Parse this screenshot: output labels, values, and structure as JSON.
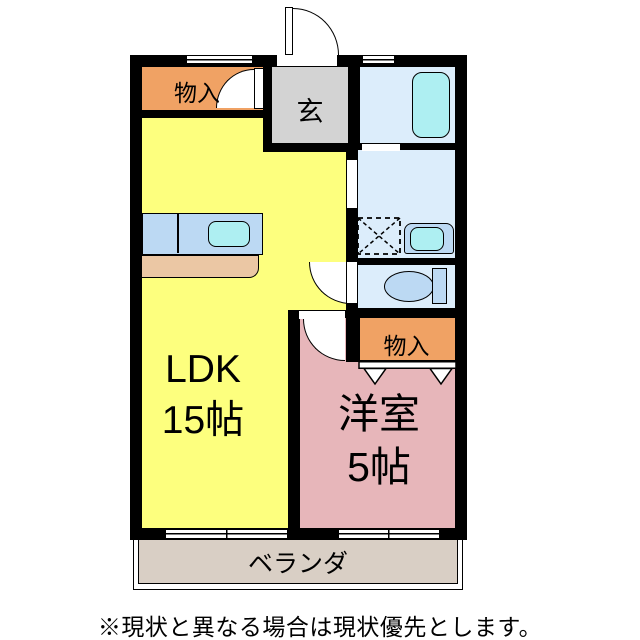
{
  "floor_plan": {
    "rooms": {
      "ldk": {
        "label": "LDK",
        "area": "15帖",
        "color": "#FDFF7E"
      },
      "western_room": {
        "label": "洋室",
        "area": "5帖",
        "color": "#E7B6BA"
      },
      "entrance": {
        "label": "玄",
        "color": "#D3D3D3"
      },
      "storage_top": {
        "label": "物入",
        "color": "#F0A264"
      },
      "storage_bedroom": {
        "label": "物入",
        "color": "#F0A264"
      },
      "bathroom": {
        "color": "#DCEDFB"
      },
      "washroom": {
        "color": "#DCEDFB"
      },
      "toilet_room": {
        "color": "#DCEDFB"
      },
      "veranda": {
        "label": "ベランダ",
        "color": "#D9CFC5"
      }
    },
    "fixtures": {
      "bathtub": "bathtub",
      "kitchen_counter": "kitchen-counter",
      "kitchen_sink": "kitchen-sink",
      "washing_machine_space": "washing-machine-space",
      "wash_basin": "wash-basin",
      "toilet": "toilet",
      "entrance_door": "swing-door",
      "storage_doors": "folding-doors"
    },
    "colors": {
      "wall": "#000000",
      "fixture_blue": "#BCD9F3",
      "water_cyan": "#AEEFF2",
      "counter_tan": "#EBC7A4"
    }
  },
  "footer": {
    "note": "※現状と異なる場合は現状優先とします。"
  }
}
